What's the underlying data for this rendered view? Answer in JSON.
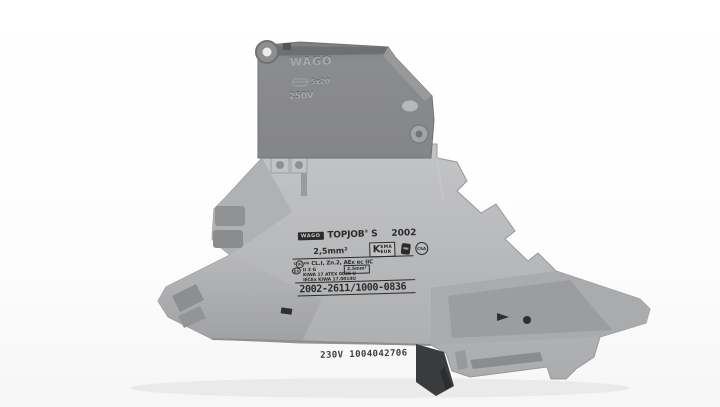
{
  "colors": {
    "background": "#ffffff",
    "body_gray": "#b4b5b7",
    "body_gray_dark": "#9a9b9d",
    "carrier_gray": "#87888a",
    "recess_gray": "#8d8e90",
    "rail_dark": "#3a3b3d",
    "print_ink": "#2b2b2b"
  },
  "product": {
    "brand_logo": "WAGO",
    "series_label": "TOPJOB",
    "series_reg": "®",
    "series_suffix": "S",
    "series_number": "2002",
    "cross_section": "2,5mm²",
    "kema": {
      "k": "K",
      "line1": "EMA",
      "line2": "EUR"
    },
    "csa_mark": "CSA",
    "ul_prefix": "c",
    "ul_mark": "UL",
    "ul_suffix": "us",
    "hazloc_rating": "CL.I, Zn.2, AEx ec IIC",
    "ex_mark": "Ex",
    "atex_category": "II 3 G",
    "atex_cross_section": "2,5mm²",
    "atex_certificate": "KIWA 17 ATEX 0038 U",
    "iecex_certificate": "IECEx KIWA 17.0014U",
    "order_number": "2002-2611/1000-0836",
    "bottom_marking": "230V 1004042706",
    "fuse_carrier": {
      "brand": "WAGO",
      "fuse_size": "5x20",
      "voltage": "250V"
    }
  }
}
